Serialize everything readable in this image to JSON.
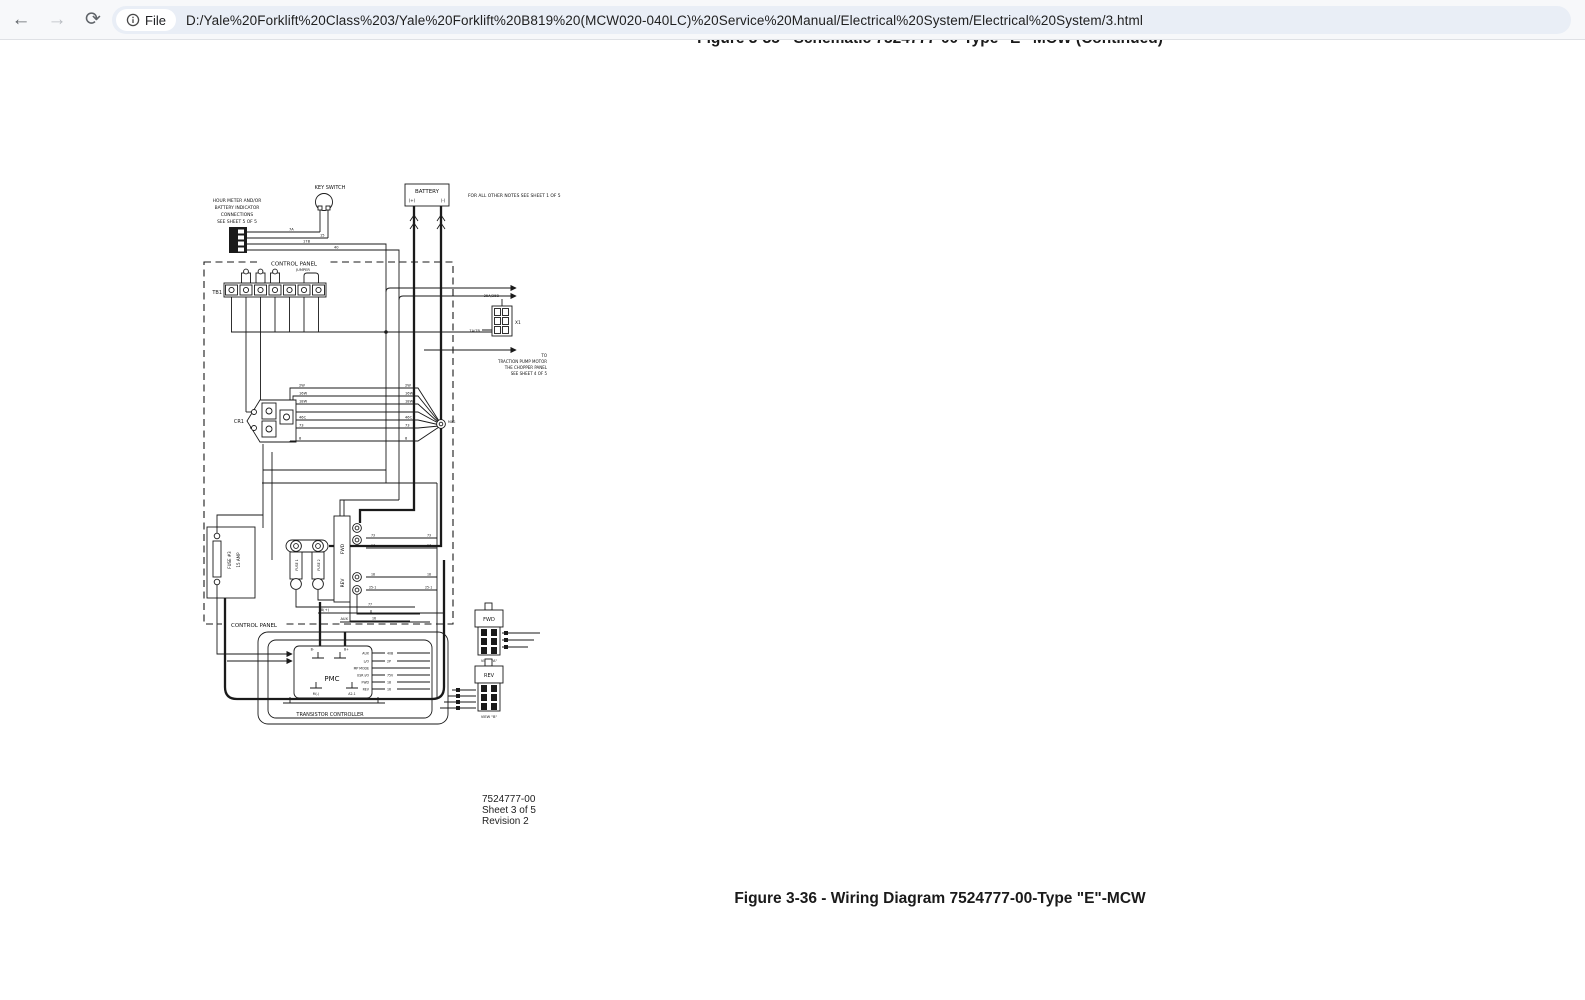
{
  "browser": {
    "back_icon": "←",
    "forward_icon": "→",
    "reload_icon": "⟳",
    "file_chip": {
      "label": "File"
    },
    "url": "D:/Yale%20Forklift%20Class%203/Yale%20Forklift%20B819%20(MCW020-040LC)%20Service%20Manual/Electrical%20System/Electrical%20System/3.html"
  },
  "page": {
    "top_caption": "Figure 3-35 - Schematic 7524777-00-Type \"E\"-MCW (Continued)",
    "bottom_caption": "Figure 3-36 - Wiring Diagram 7524777-00-Type \"E\"-MCW",
    "sheet_info": [
      "7524777-00",
      "Sheet 3 of 5",
      "Revision 2"
    ]
  },
  "diagram": {
    "notes": {
      "hour_meter_1": "HOUR METER AND/OR",
      "hour_meter_2": "BATTERY INDICATOR",
      "hour_meter_3": "CONNECTIONS",
      "hour_meter_4": "SEE SHEET 5 OF 5",
      "other_notes": "FOR ALL OTHER NOTES SEE SHEET 1 OF 5",
      "traction_1": "TO",
      "traction_2": "TRACTION PUMP MOTOR",
      "traction_3": "THE CHOPPER PANEL",
      "traction_4": "SEE SHEET 4 OF 5"
    },
    "components": {
      "key_switch": "KEY SWITCH",
      "battery": "BATTERY",
      "battery_pos": "(+)",
      "battery_neg": "(-)",
      "control_panel": "CONTROL PANEL",
      "tb1": "TB1",
      "jumper": "JUMPER",
      "cr1": "CR1",
      "x1": "X1",
      "mag": "MAG",
      "fuse3_1": "FUSE #3",
      "fuse3_2": "15 AMP",
      "fuse1": "FUSE 1",
      "fuse2": "FUSE 2",
      "fwd_contactor": "FWD",
      "rev_contactor": "REV",
      "pmc": "PMC",
      "transistor_controller": "TRANSISTOR CONTROLLER",
      "fwd_connector": "FWD",
      "rev_connector": "REV",
      "view_a": "VIEW \"A\"",
      "view_b": "VIEW \"B\""
    },
    "pmc_pins": {
      "b_minus": "B-",
      "b_plus": "B+",
      "m_minus": "M(-)",
      "a2_1": "A2-1",
      "b_plus_feed": "B(+)",
      "aux_feed": "AUX",
      "rows": [
        {
          "label": "AUX",
          "wire": "40B"
        },
        {
          "label": "L/O",
          "wire": "2P"
        },
        {
          "label": "MP MODE",
          "wire": ""
        },
        {
          "label": "USR I/O",
          "wire": "75V"
        },
        {
          "label": "FWD",
          "wire": "18"
        },
        {
          "label": "REV",
          "wire": "16"
        }
      ]
    },
    "wires": {
      "hm_1": "7A",
      "hm_2": "15",
      "hm_3": "17B",
      "hm_4": "40",
      "x1_top": "25A/25B",
      "x1_left": "7A/7B",
      "cr1_1": "2W",
      "cr1_2": "16W",
      "cr1_3": "18W",
      "cr1_4": "46C",
      "cr1_5": "73",
      "cr1_6": "8",
      "cont_1": "73",
      "cont_2": "14",
      "cont_3": "18",
      "cont_4": "25-1",
      "bot_1": "77",
      "bot_2": "8",
      "bot_3": "16"
    }
  }
}
